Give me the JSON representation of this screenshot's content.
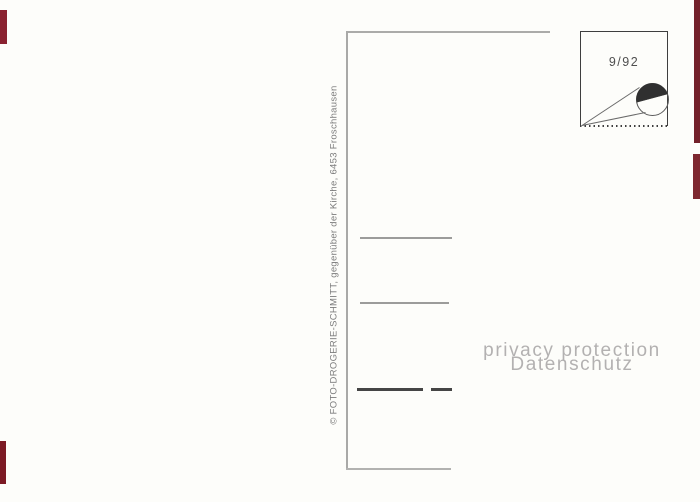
{
  "postcard": {
    "copyright_text": "© FOTO-DROGERIE-SCHMITT, gegenüber der Kirche, 6453 Froschhausen",
    "stamp_box": {
      "date_code": "9/92",
      "icon": "page-curl-icon"
    },
    "watermark": {
      "line1": "privacy protection",
      "line2": "Datenschutz"
    }
  },
  "colors": {
    "card_bg": "#fdfdfa",
    "edge_mark_red": "#7d2029",
    "divider_gray": "#a9a9a7",
    "address_line_gray": "#9c9c9a",
    "address_line_dark": "#454545",
    "copyright_text_gray": "#7b7b7b",
    "stamp_border": "#3e3e3e",
    "stamp_label_gray": "#4f4f4f",
    "watermark_gray": "#b3b1b1"
  }
}
